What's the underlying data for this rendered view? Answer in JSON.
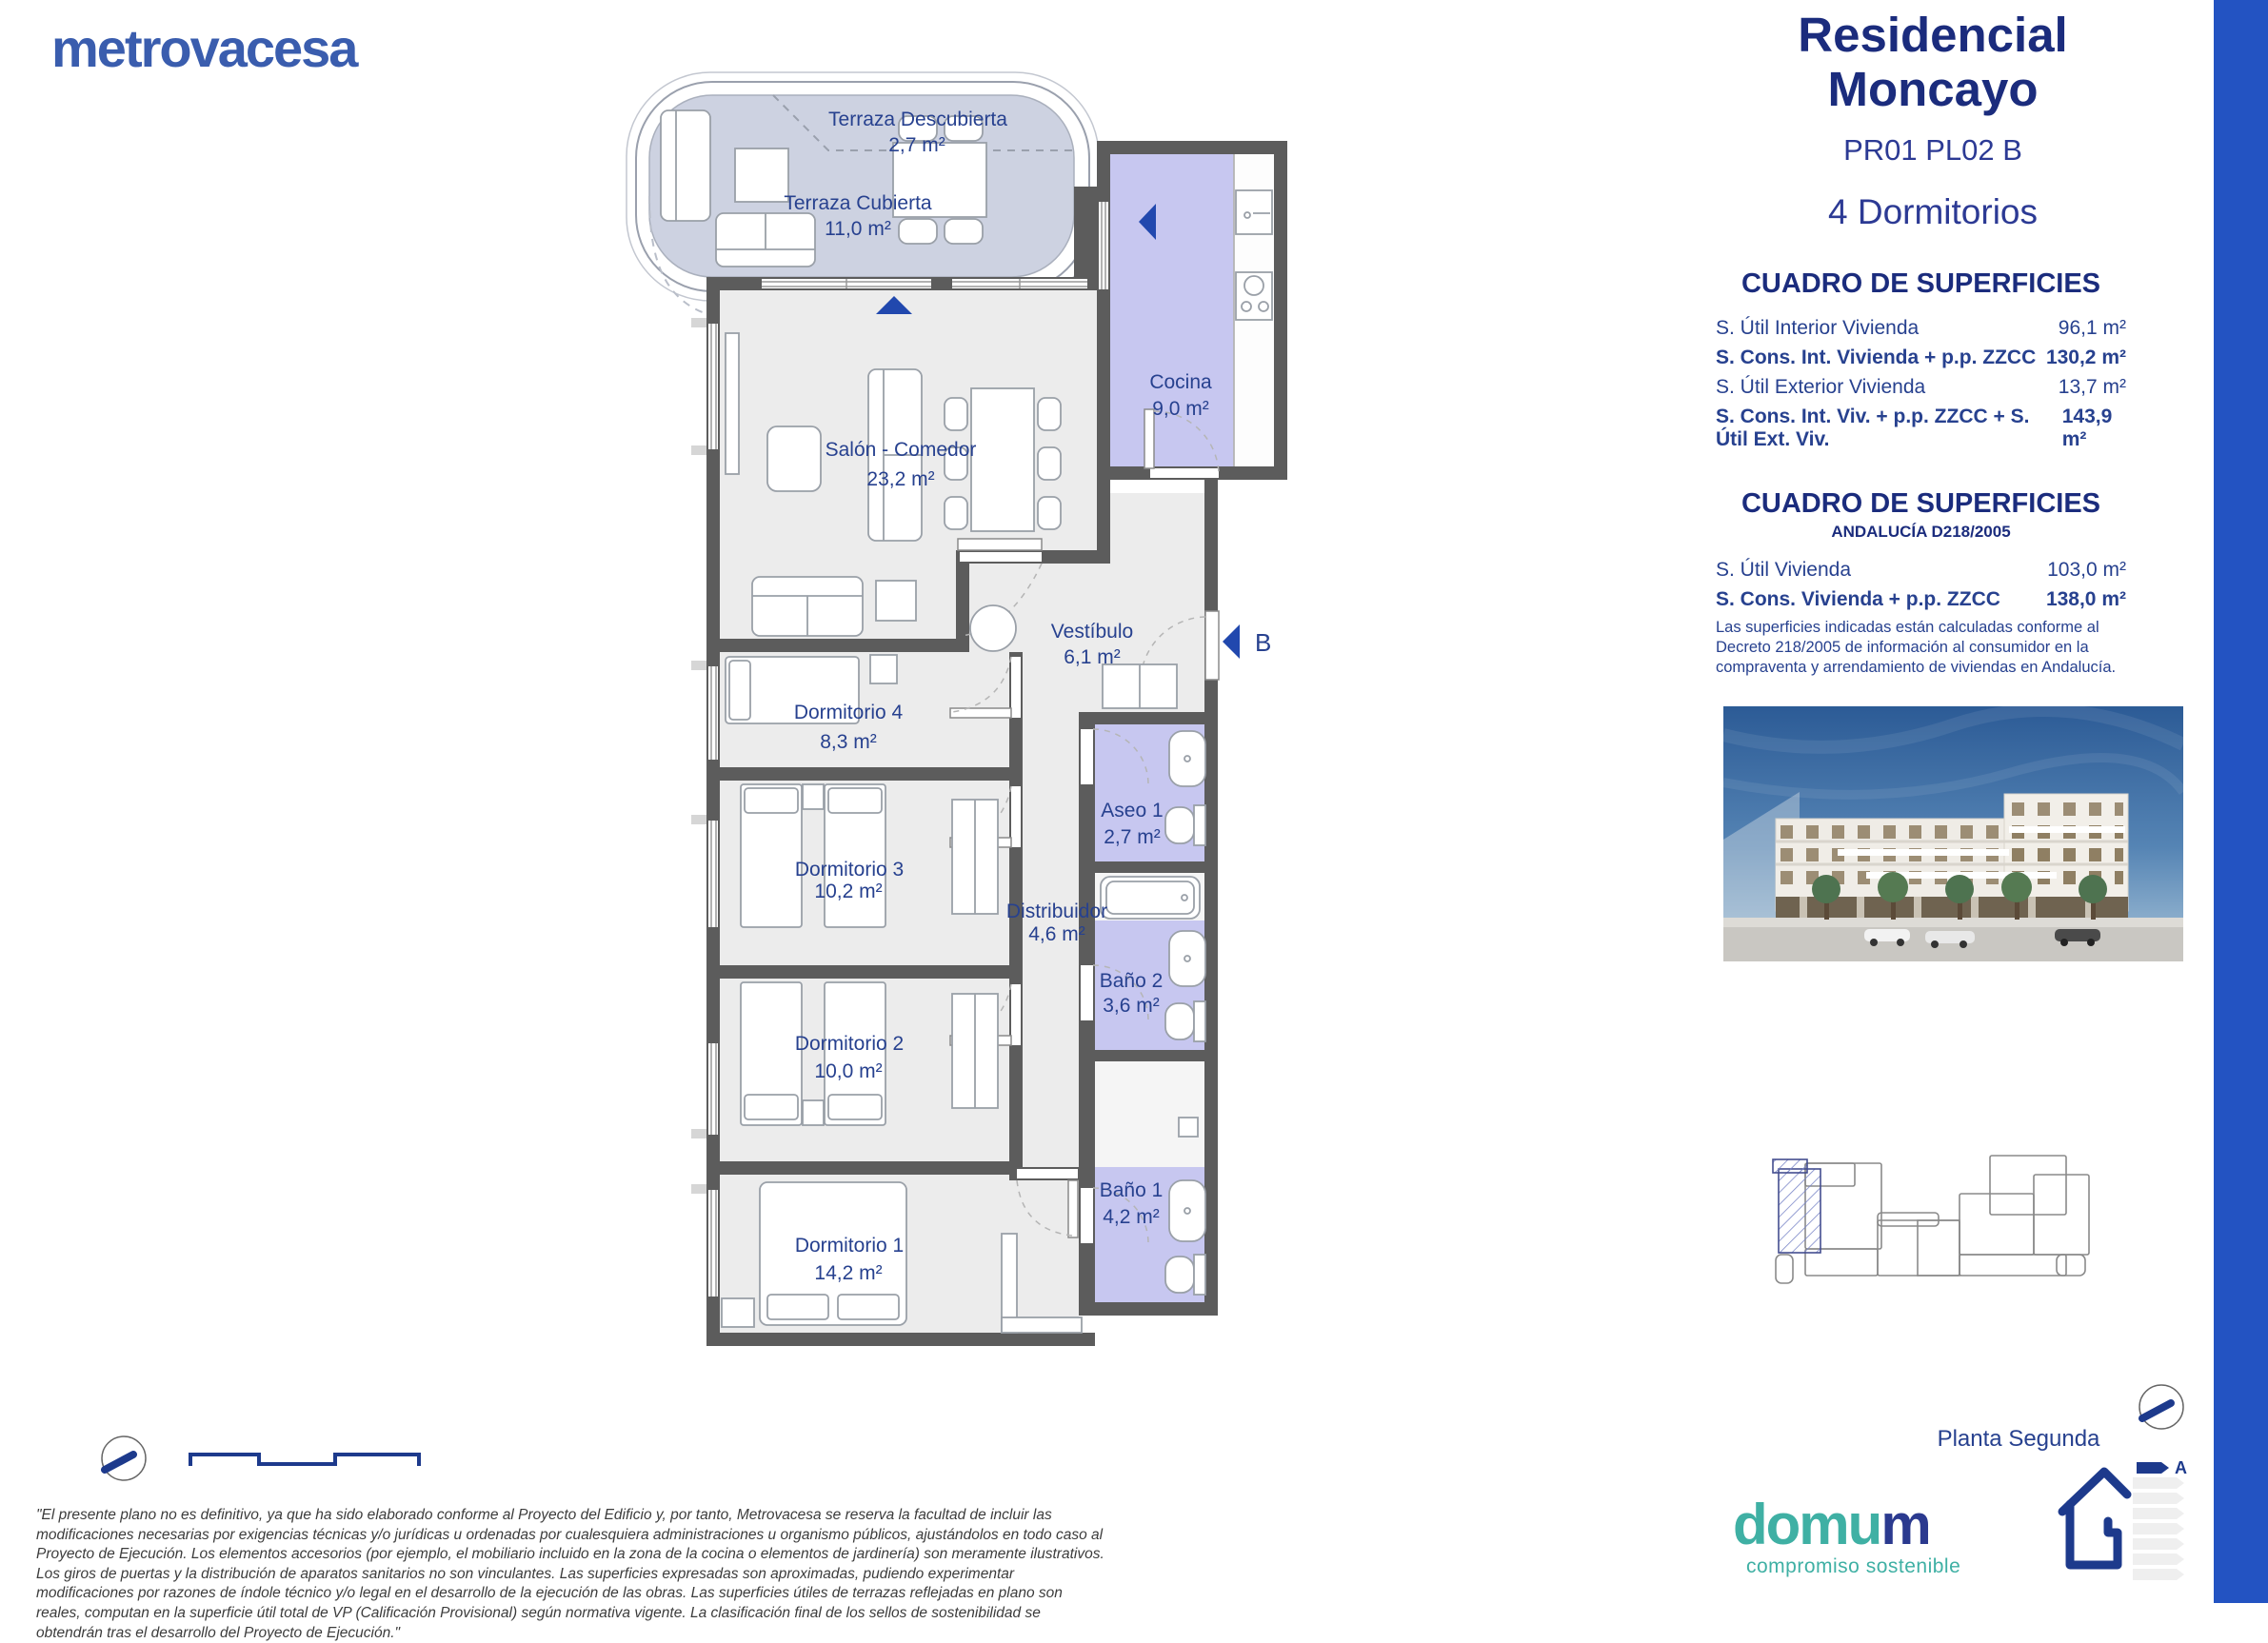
{
  "brand": {
    "name": "metrovacesa"
  },
  "panel": {
    "title_line1": "Residencial",
    "title_line2": "Moncayo",
    "unit_code": "PR01 PL02 B",
    "type": "4 Dormitorios",
    "table1": {
      "title": "CUADRO DE SUPERFICIES",
      "rows": [
        {
          "label": "S. Útil Interior Vivienda",
          "value": "96,1 m²",
          "bold": false
        },
        {
          "label": "S. Cons. Int. Vivienda + p.p. ZZCC",
          "value": "130,2 m²",
          "bold": true
        },
        {
          "label": "S. Útil Exterior Vivienda",
          "value": "13,7 m²",
          "bold": false
        },
        {
          "label": "S. Cons. Int. Viv. + p.p. ZZCC + S. Útil Ext. Viv.",
          "value": "143,9 m²",
          "bold": true
        }
      ]
    },
    "table2": {
      "title": "CUADRO DE SUPERFICIES",
      "subtitle": "ANDALUCÍA D218/2005",
      "rows": [
        {
          "label": "S. Útil Vivienda",
          "value": "103,0 m²",
          "bold": false
        },
        {
          "label": "S. Cons. Vivienda + p.p. ZZCC",
          "value": "138,0 m²",
          "bold": true
        }
      ],
      "note": "Las superficies indicadas están calculadas conforme al Decreto 218/2005 de información al consumidor en la compraventa y arrendamiento de viviendas en Andalucía."
    },
    "keyplan_caption": "Planta Segunda",
    "energy_rating": "A",
    "domum": {
      "logo_teal": "domu",
      "logo_navy": "m",
      "tagline": "compromiso sostenible"
    }
  },
  "floorplan": {
    "entrance_label": "B",
    "rooms": [
      {
        "name": "Terraza Descubierta",
        "area": "2,7 m²"
      },
      {
        "name": "Terraza Cubierta",
        "area": "11,0 m²"
      },
      {
        "name": "Cocina",
        "area": "9,0 m²"
      },
      {
        "name": "Salón - Comedor",
        "area": "23,2 m²"
      },
      {
        "name": "Vestíbulo",
        "area": "6,1 m²"
      },
      {
        "name": "Dormitorio 4",
        "area": "8,3 m²"
      },
      {
        "name": "Aseo 1",
        "area": "2,7 m²"
      },
      {
        "name": "Dormitorio 3",
        "area": "10,2 m²"
      },
      {
        "name": "Distribuidor",
        "area": "4,6 m²"
      },
      {
        "name": "Baño 2",
        "area": "3,6 m²"
      },
      {
        "name": "Dormitorio 2",
        "area": "10,0 m²"
      },
      {
        "name": "Baño 1",
        "area": "4,2 m²"
      },
      {
        "name": "Dormitorio 1",
        "area": "14,2 m²"
      }
    ]
  },
  "disclaimer": "\"El presente plano no es definitivo, ya que ha sido elaborado conforme al Proyecto del Edificio y, por tanto, Metrovacesa se reserva la facultad de incluir las modificaciones necesarias por exigencias técnicas y/o jurídicas u ordenadas por cualesquiera administraciones u organismo públicos, ajustándolos en todo caso al Proyecto de Ejecución. Los elementos accesorios (por ejemplo, el mobiliario incluido en la zona de la cocina o elementos de jardinería) son meramente ilustrativos. Los giros de puertas y la distribución de aparatos sanitarios no son vinculantes. Las superficies expresadas son aproximadas, pudiendo experimentar modificaciones por razones de índole técnico y/o legal en el desarrollo de la ejecución de las obras. Las superficies útiles de terrazas reflejadas en plano son reales, computan en la superficie útil total de VP (Calificación Provisional) según normativa vigente. La clasificación final de los sellos de sostenibilidad se obtendrán tras el desarrollo del Proyecto de Ejecución.\"",
  "colors": {
    "accent_blue": "#2353c2",
    "navy_title": "#1b2c7d",
    "label_blue": "#27418f",
    "brand_blue": "#3a5dae",
    "wall_gray": "#5c5c5c",
    "wet_room_lavender": "#c7c7f0",
    "terrace_gray_blue": "#cdd2e1",
    "room_gray": "#ececec",
    "domum_teal": "#3fb0a4"
  }
}
